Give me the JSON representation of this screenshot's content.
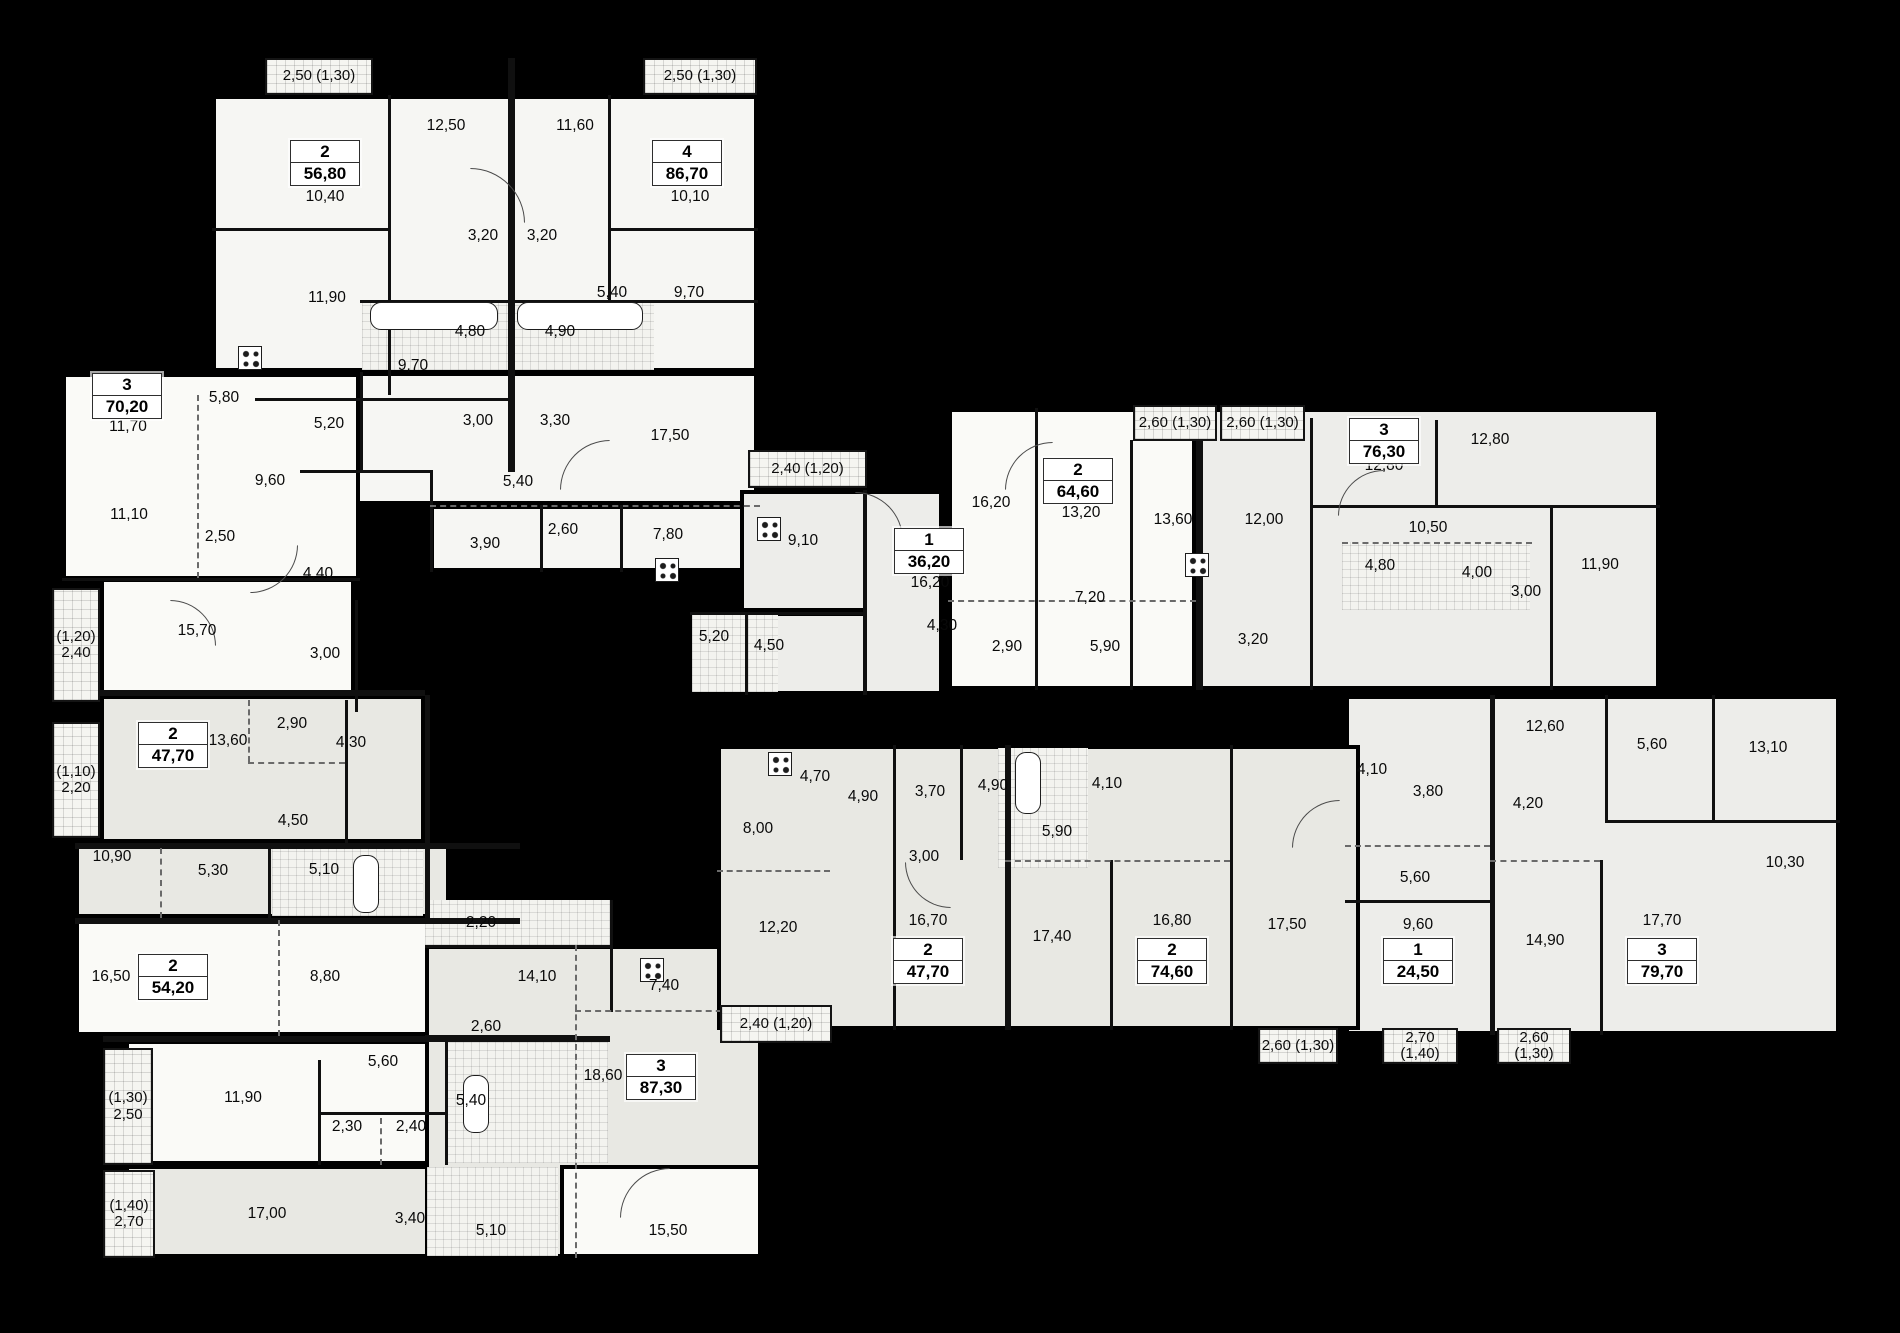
{
  "title": "residential-floor-plan",
  "colors": {
    "background": "#000000",
    "wall": "#101010",
    "w1": "#fafaf7",
    "w2": "#f6f6f3",
    "g1": "#e8e8e3",
    "g2": "#ededea",
    "hatch": "#f5f5f1"
  },
  "plan": {
    "blocks": [
      {
        "x": 212,
        "y": 95,
        "w": 546,
        "h": 277,
        "f": "w2"
      },
      {
        "x": 255,
        "y": 372,
        "w": 503,
        "h": 133,
        "f": "w2"
      },
      {
        "x": 430,
        "y": 505,
        "w": 330,
        "h": 67,
        "f": "w2"
      },
      {
        "x": 62,
        "y": 373,
        "w": 298,
        "h": 207,
        "f": "w1"
      },
      {
        "x": 100,
        "y": 578,
        "w": 255,
        "h": 134,
        "f": "w1"
      },
      {
        "x": 100,
        "y": 695,
        "w": 325,
        "h": 148,
        "f": "g1"
      },
      {
        "x": 75,
        "y": 843,
        "w": 375,
        "h": 75,
        "f": "g1"
      },
      {
        "x": 75,
        "y": 918,
        "w": 372,
        "h": 118,
        "f": "w1"
      },
      {
        "x": 125,
        "y": 1040,
        "w": 485,
        "h": 125,
        "f": "w1"
      },
      {
        "x": 125,
        "y": 1165,
        "w": 485,
        "h": 93,
        "f": "g1"
      },
      {
        "x": 425,
        "y": 900,
        "w": 185,
        "h": 45,
        "f": "g2"
      },
      {
        "x": 425,
        "y": 945,
        "w": 337,
        "h": 313,
        "f": "g1"
      },
      {
        "x": 560,
        "y": 1165,
        "w": 202,
        "h": 93,
        "f": "w1"
      },
      {
        "x": 740,
        "y": 490,
        "w": 203,
        "h": 122,
        "f": "g2"
      },
      {
        "x": 690,
        "y": 612,
        "w": 253,
        "h": 83,
        "f": "g2"
      },
      {
        "x": 863,
        "y": 490,
        "w": 80,
        "h": 205,
        "f": "g2"
      },
      {
        "x": 948,
        "y": 408,
        "w": 248,
        "h": 282,
        "f": "w1"
      },
      {
        "x": 1196,
        "y": 408,
        "w": 464,
        "h": 282,
        "f": "g2"
      },
      {
        "x": 1345,
        "y": 695,
        "w": 495,
        "h": 340,
        "f": "g2"
      },
      {
        "x": 717,
        "y": 745,
        "w": 643,
        "h": 285,
        "f": "g1"
      }
    ],
    "wet_zones": [
      {
        "x": 362,
        "y": 300,
        "w": 292,
        "h": 70
      },
      {
        "x": 425,
        "y": 900,
        "w": 185,
        "h": 45
      },
      {
        "x": 692,
        "y": 614,
        "w": 86,
        "h": 78
      },
      {
        "x": 998,
        "y": 748,
        "w": 90,
        "h": 120
      },
      {
        "x": 1342,
        "y": 542,
        "w": 188,
        "h": 68
      },
      {
        "x": 272,
        "y": 846,
        "w": 151,
        "h": 70
      },
      {
        "x": 447,
        "y": 1042,
        "w": 161,
        "h": 121
      },
      {
        "x": 427,
        "y": 1167,
        "w": 131,
        "h": 89
      }
    ],
    "partitions": [
      [
        "v",
        508,
        58,
        414,
        7
      ],
      [
        "v",
        388,
        95,
        300,
        3
      ],
      [
        "v",
        608,
        95,
        205,
        3
      ],
      [
        "h",
        212,
        228,
        176,
        3
      ],
      [
        "h",
        610,
        228,
        148,
        3
      ],
      [
        "h",
        360,
        300,
        398,
        3
      ],
      [
        "h",
        255,
        398,
        253,
        3
      ],
      [
        "v",
        430,
        470,
        102,
        3
      ],
      [
        "h",
        430,
        505,
        330,
        2,
        "d"
      ],
      [
        "v",
        540,
        505,
        67,
        3
      ],
      [
        "v",
        620,
        505,
        67,
        3
      ],
      [
        "h",
        300,
        470,
        130,
        3
      ],
      [
        "v",
        360,
        372,
        98,
        3
      ],
      [
        "h",
        62,
        578,
        298,
        3
      ],
      [
        "v",
        197,
        395,
        183,
        2,
        "d"
      ],
      [
        "h",
        52,
        690,
        373,
        6
      ],
      [
        "v",
        355,
        600,
        112,
        3
      ],
      [
        "h",
        75,
        843,
        445,
        6
      ],
      [
        "h",
        75,
        918,
        445,
        6
      ],
      [
        "v",
        425,
        695,
        223,
        5
      ],
      [
        "v",
        345,
        700,
        143,
        3
      ],
      [
        "v",
        248,
        700,
        62,
        2,
        "d"
      ],
      [
        "h",
        248,
        762,
        97,
        2,
        "d"
      ],
      [
        "v",
        268,
        848,
        70,
        3
      ],
      [
        "v",
        160,
        848,
        70,
        2,
        "d"
      ],
      [
        "h",
        103,
        1036,
        507,
        6
      ],
      [
        "v",
        278,
        920,
        116,
        2,
        "d"
      ],
      [
        "v",
        318,
        1060,
        105,
        3
      ],
      [
        "h",
        318,
        1112,
        127,
        3
      ],
      [
        "v",
        380,
        1118,
        47,
        2,
        "d"
      ],
      [
        "v",
        445,
        1040,
        125,
        3
      ],
      [
        "h",
        425,
        945,
        185,
        3
      ],
      [
        "v",
        610,
        900,
        112,
        3
      ],
      [
        "v",
        575,
        945,
        313,
        2,
        "d"
      ],
      [
        "h",
        425,
        1035,
        150,
        3
      ],
      [
        "h",
        575,
        1010,
        187,
        2,
        "d"
      ],
      [
        "v",
        863,
        490,
        205,
        4
      ],
      [
        "h",
        690,
        612,
        173,
        3
      ],
      [
        "v",
        745,
        612,
        83,
        3
      ],
      [
        "v",
        1035,
        408,
        282,
        3
      ],
      [
        "v",
        1130,
        440,
        250,
        3
      ],
      [
        "v",
        1196,
        405,
        285,
        7
      ],
      [
        "v",
        1310,
        418,
        272,
        3
      ],
      [
        "v",
        1435,
        420,
        85,
        3
      ],
      [
        "h",
        1310,
        505,
        350,
        3
      ],
      [
        "h",
        948,
        600,
        248,
        2,
        "d"
      ],
      [
        "v",
        1550,
        505,
        185,
        3
      ],
      [
        "h",
        1342,
        542,
        190,
        2,
        "d"
      ],
      [
        "v",
        1490,
        695,
        340,
        5
      ],
      [
        "v",
        1605,
        695,
        125,
        3
      ],
      [
        "v",
        1712,
        695,
        125,
        3
      ],
      [
        "h",
        1605,
        820,
        235,
        3
      ],
      [
        "h",
        1345,
        845,
        145,
        2,
        "d"
      ],
      [
        "v",
        1600,
        860,
        175,
        3
      ],
      [
        "h",
        1490,
        860,
        110,
        2,
        "d"
      ],
      [
        "h",
        1345,
        900,
        145,
        3
      ],
      [
        "v",
        893,
        745,
        285,
        3
      ],
      [
        "v",
        1005,
        745,
        285,
        6
      ],
      [
        "v",
        1110,
        860,
        170,
        3
      ],
      [
        "v",
        1230,
        745,
        285,
        3
      ],
      [
        "h",
        717,
        870,
        113,
        2,
        "d"
      ],
      [
        "h",
        1005,
        860,
        225,
        2,
        "d"
      ],
      [
        "v",
        960,
        745,
        115,
        3
      ]
    ],
    "balconies": [
      {
        "x": 265,
        "y": 58,
        "w": 108,
        "h": 37,
        "lines": [
          "2,50 (1,30)"
        ]
      },
      {
        "x": 643,
        "y": 58,
        "w": 114,
        "h": 37,
        "lines": [
          "2,50 (1,30)"
        ]
      },
      {
        "x": 52,
        "y": 588,
        "w": 48,
        "h": 114,
        "lines": [
          "(1,20)",
          "2,40"
        ]
      },
      {
        "x": 52,
        "y": 722,
        "w": 48,
        "h": 116,
        "lines": [
          "(1,10)",
          "2,20"
        ]
      },
      {
        "x": 103,
        "y": 1048,
        "w": 50,
        "h": 117,
        "lines": [
          "(1,30)",
          "2,50"
        ]
      },
      {
        "x": 103,
        "y": 1170,
        "w": 52,
        "h": 88,
        "lines": [
          "(1,40)",
          "2,70"
        ]
      },
      {
        "x": 748,
        "y": 450,
        "w": 119,
        "h": 38,
        "lines": [
          "2,40 (1,20)"
        ]
      },
      {
        "x": 1133,
        "y": 405,
        "w": 84,
        "h": 36,
        "lines": [
          "2,60 (1,30)"
        ]
      },
      {
        "x": 1220,
        "y": 405,
        "w": 85,
        "h": 36,
        "lines": [
          "2,60 (1,30)"
        ]
      },
      {
        "x": 720,
        "y": 1005,
        "w": 112,
        "h": 38,
        "lines": [
          "2,40 (1,20)"
        ]
      },
      {
        "x": 1258,
        "y": 1028,
        "w": 80,
        "h": 36,
        "lines": [
          "2,60 (1,30)"
        ]
      },
      {
        "x": 1382,
        "y": 1028,
        "w": 76,
        "h": 36,
        "lines": [
          "2,70 (1,40)"
        ]
      },
      {
        "x": 1497,
        "y": 1028,
        "w": 74,
        "h": 36,
        "lines": [
          "2,60 (1,30)"
        ]
      }
    ],
    "badges": [
      {
        "n": "2",
        "a": "56,80",
        "x": 325,
        "y": 163
      },
      {
        "n": "4",
        "a": "86,70",
        "x": 687,
        "y": 163
      },
      {
        "n": "3",
        "a": "70,20",
        "x": 127,
        "y": 396
      },
      {
        "n": "2",
        "a": "47,70",
        "x": 173,
        "y": 745
      },
      {
        "n": "2",
        "a": "54,20",
        "x": 173,
        "y": 977
      },
      {
        "n": "3",
        "a": "87,30",
        "x": 661,
        "y": 1077
      },
      {
        "n": "1",
        "a": "36,20",
        "x": 929,
        "y": 551
      },
      {
        "n": "2",
        "a": "64,60",
        "x": 1078,
        "y": 481
      },
      {
        "n": "3",
        "a": "76,30",
        "x": 1384,
        "y": 441
      },
      {
        "n": "2",
        "a": "47,70",
        "x": 928,
        "y": 961
      },
      {
        "n": "2",
        "a": "74,60",
        "x": 1172,
        "y": 961
      },
      {
        "n": "1",
        "a": "24,50",
        "x": 1418,
        "y": 961
      },
      {
        "n": "3",
        "a": "79,70",
        "x": 1662,
        "y": 961
      }
    ],
    "room_labels": [
      [
        "12,50",
        446,
        126
      ],
      [
        "11,60",
        575,
        126
      ],
      [
        "10,40",
        325,
        197
      ],
      [
        "10,10",
        690,
        197
      ],
      [
        "3,20",
        483,
        236
      ],
      [
        "3,20",
        542,
        236
      ],
      [
        "11,90",
        327,
        298
      ],
      [
        "5,40",
        612,
        293
      ],
      [
        "9,70",
        689,
        293
      ],
      [
        "4,80",
        470,
        332
      ],
      [
        "4,90",
        560,
        332
      ],
      [
        "9,70",
        413,
        366
      ],
      [
        "5,20",
        329,
        424
      ],
      [
        "3,00",
        478,
        421
      ],
      [
        "3,30",
        555,
        421
      ],
      [
        "17,50",
        670,
        436
      ],
      [
        "5,40",
        518,
        482
      ],
      [
        "3,90",
        485,
        544
      ],
      [
        "2,60",
        563,
        530
      ],
      [
        "7,80",
        668,
        535
      ],
      [
        "11,70",
        128,
        427
      ],
      [
        "5,80",
        224,
        398
      ],
      [
        "9,60",
        270,
        481
      ],
      [
        "11,10",
        129,
        515
      ],
      [
        "2,50",
        220,
        537
      ],
      [
        "4,40",
        318,
        574
      ],
      [
        "15,70",
        197,
        631
      ],
      [
        "3,00",
        325,
        654
      ],
      [
        "2,90",
        292,
        724
      ],
      [
        "13,60",
        228,
        741
      ],
      [
        "4,30",
        351,
        743
      ],
      [
        "4,50",
        293,
        821
      ],
      [
        "10,90",
        112,
        857
      ],
      [
        "5,30",
        213,
        871
      ],
      [
        "5,10",
        324,
        870
      ],
      [
        "16,50",
        111,
        977
      ],
      [
        "8,80",
        325,
        977
      ],
      [
        "5,60",
        383,
        1062
      ],
      [
        "2,60",
        486,
        1027
      ],
      [
        "11,90",
        243,
        1098
      ],
      [
        "5,40",
        471,
        1101
      ],
      [
        "2,30",
        347,
        1127
      ],
      [
        "2,40",
        411,
        1127
      ],
      [
        "17,00",
        267,
        1214
      ],
      [
        "3,40",
        410,
        1219
      ],
      [
        "5,10",
        491,
        1231
      ],
      [
        "15,50",
        668,
        1231
      ],
      [
        "2,20",
        481,
        923
      ],
      [
        "14,10",
        537,
        977
      ],
      [
        "7,40",
        664,
        986
      ],
      [
        "18,60",
        603,
        1076
      ],
      [
        "9,10",
        803,
        541
      ],
      [
        "16,20",
        930,
        583
      ],
      [
        "5,20",
        714,
        637
      ],
      [
        "4,50",
        769,
        646
      ],
      [
        "16,20",
        991,
        503
      ],
      [
        "13,20",
        1081,
        513
      ],
      [
        "13,60",
        1173,
        520
      ],
      [
        "12,00",
        1264,
        520
      ],
      [
        "12,80",
        1384,
        466
      ],
      [
        "12,80",
        1490,
        440
      ],
      [
        "7,20",
        1090,
        598
      ],
      [
        "4,30",
        942,
        626
      ],
      [
        "2,90",
        1007,
        647
      ],
      [
        "5,90",
        1105,
        647
      ],
      [
        "3,20",
        1253,
        640
      ],
      [
        "10,50",
        1428,
        528
      ],
      [
        "4,80",
        1380,
        566
      ],
      [
        "4,00",
        1477,
        573
      ],
      [
        "3,00",
        1526,
        592
      ],
      [
        "11,90",
        1600,
        565
      ],
      [
        "12,60",
        1545,
        727
      ],
      [
        "5,60",
        1652,
        745
      ],
      [
        "13,10",
        1768,
        748
      ],
      [
        "4,10",
        1372,
        770
      ],
      [
        "3,80",
        1428,
        792
      ],
      [
        "4,20",
        1528,
        804
      ],
      [
        "5,60",
        1415,
        878
      ],
      [
        "10,30",
        1785,
        863
      ],
      [
        "9,60",
        1418,
        925
      ],
      [
        "14,90",
        1545,
        941
      ],
      [
        "17,70",
        1662,
        921
      ],
      [
        "4,70",
        815,
        777
      ],
      [
        "4,90",
        863,
        797
      ],
      [
        "8,00",
        758,
        829
      ],
      [
        "3,70",
        930,
        792
      ],
      [
        "4,90",
        993,
        786
      ],
      [
        "4,10",
        1107,
        784
      ],
      [
        "5,90",
        1057,
        832
      ],
      [
        "3,00",
        924,
        857
      ],
      [
        "12,20",
        778,
        928
      ],
      [
        "16,70",
        928,
        921
      ],
      [
        "17,40",
        1052,
        937
      ],
      [
        "16,80",
        1172,
        921
      ],
      [
        "17,50",
        1287,
        925
      ]
    ],
    "fixtures": [
      {
        "t": "bathtub-icon",
        "x": 370,
        "y": 302,
        "w": 128,
        "h": 28
      },
      {
        "t": "bathtub-icon",
        "x": 517,
        "y": 302,
        "w": 126,
        "h": 28
      },
      {
        "t": "bathtub-icon",
        "x": 353,
        "y": 855,
        "w": 26,
        "h": 58
      },
      {
        "t": "bathtub-icon",
        "x": 1015,
        "y": 752,
        "w": 26,
        "h": 62
      },
      {
        "t": "bathtub-icon",
        "x": 463,
        "y": 1075,
        "w": 26,
        "h": 58
      },
      {
        "t": "stove-icon",
        "x": 238,
        "y": 346
      },
      {
        "t": "stove-icon",
        "x": 757,
        "y": 517
      },
      {
        "t": "stove-icon",
        "x": 768,
        "y": 752
      },
      {
        "t": "stove-icon",
        "x": 1185,
        "y": 553
      },
      {
        "t": "stove-icon",
        "x": 640,
        "y": 958
      },
      {
        "t": "stove-icon",
        "x": 655,
        "y": 558
      }
    ],
    "doors": [
      [
        470,
        168,
        55,
        "tr"
      ],
      [
        560,
        440,
        50,
        "tl"
      ],
      [
        250,
        545,
        48,
        "br"
      ],
      [
        855,
        492,
        48,
        "tr"
      ],
      [
        1005,
        442,
        48,
        "tl"
      ],
      [
        1338,
        470,
        46,
        "tl"
      ],
      [
        1292,
        800,
        48,
        "tl"
      ],
      [
        905,
        862,
        46,
        "bl"
      ],
      [
        620,
        1168,
        50,
        "tl"
      ],
      [
        170,
        600,
        46,
        "tr"
      ]
    ]
  }
}
